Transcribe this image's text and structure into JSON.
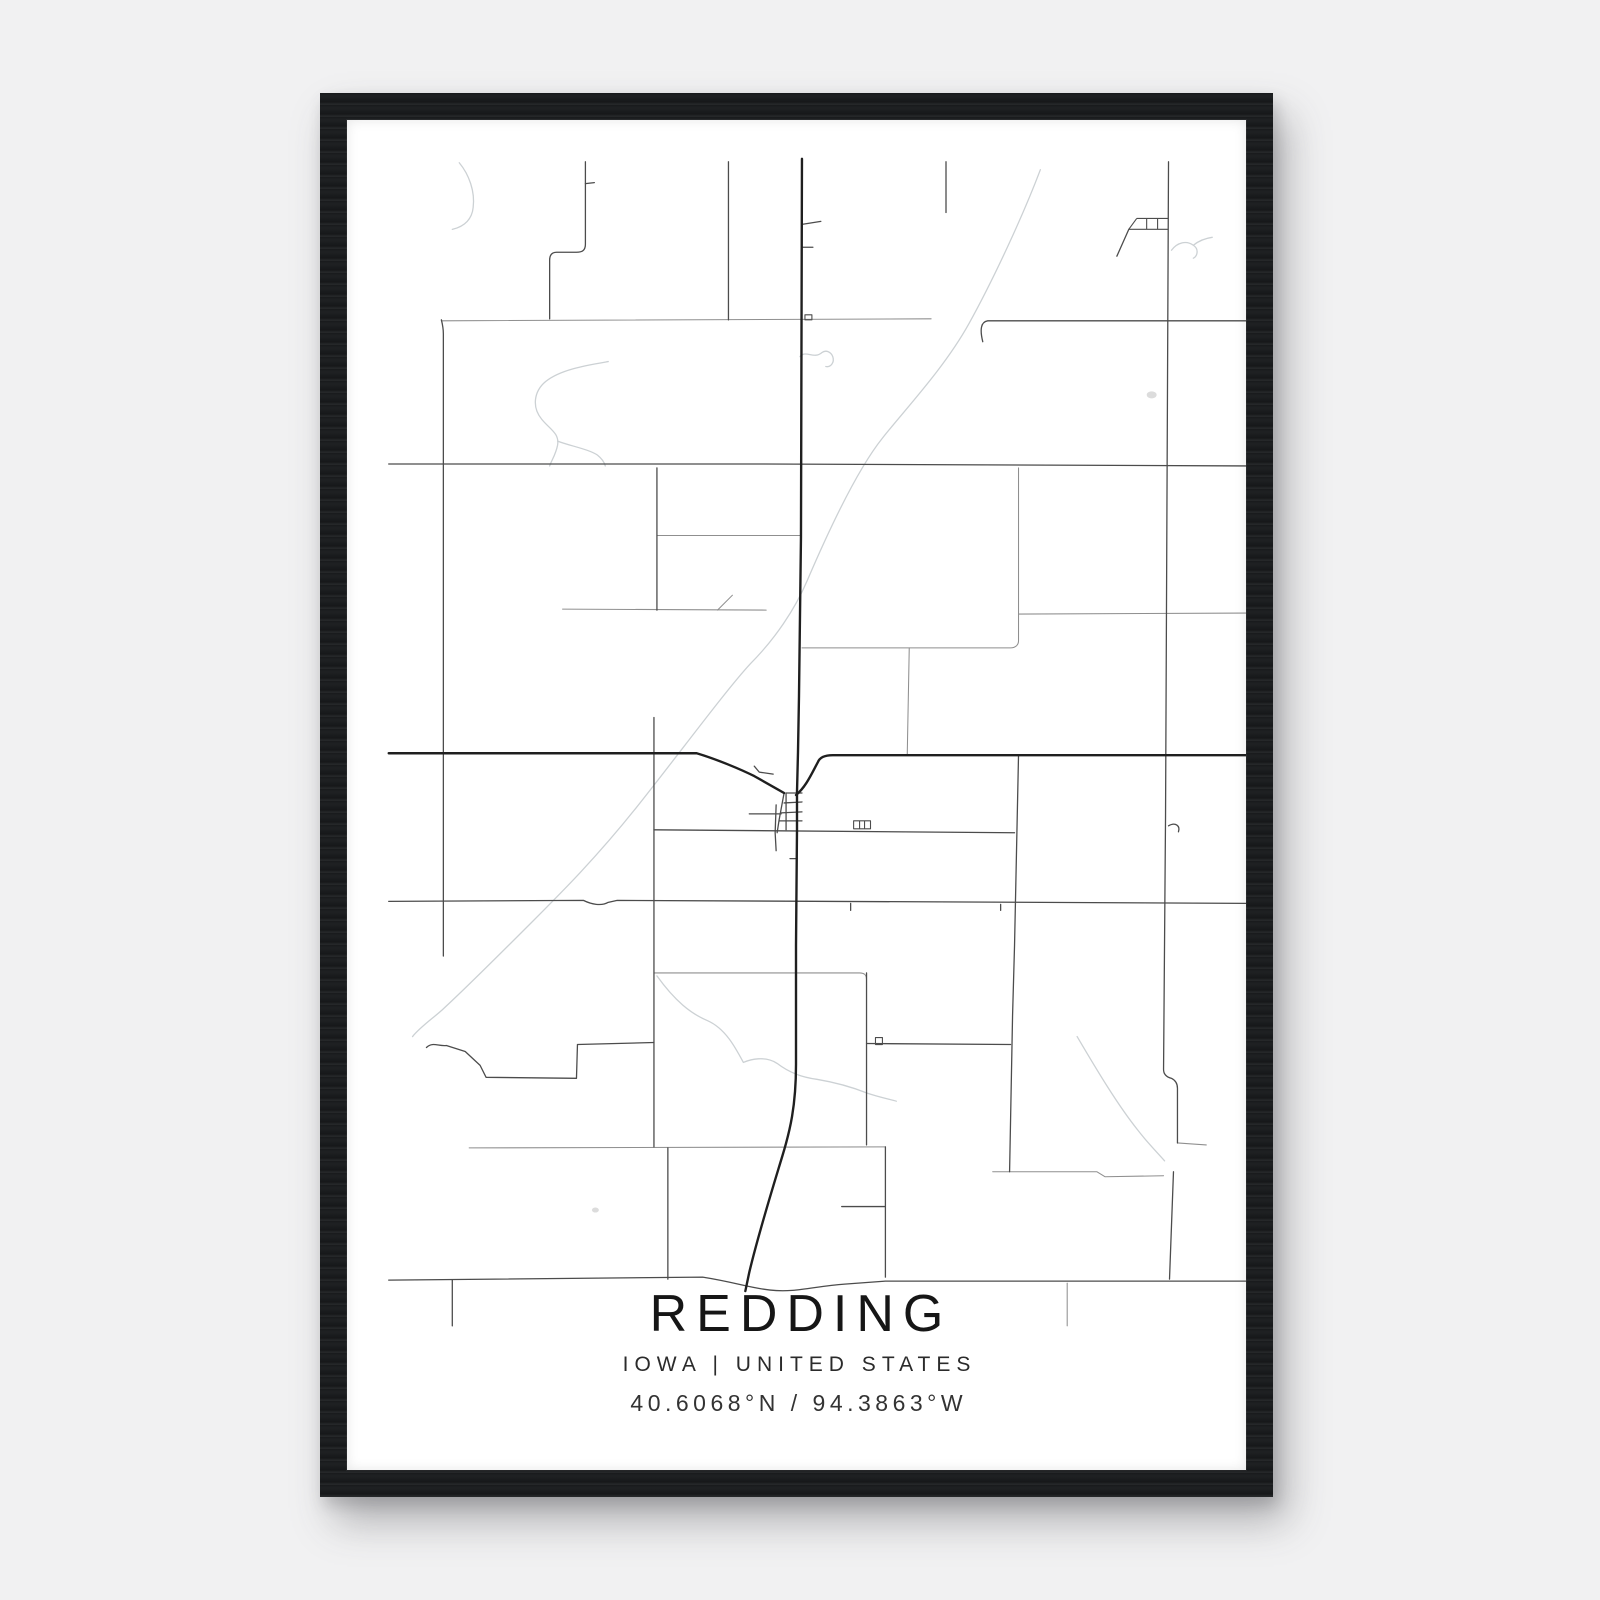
{
  "poster": {
    "title": "REDDING",
    "subtitle": "IOWA | UNITED STATES",
    "coordinates": "40.6068°N / 94.3863°W"
  },
  "colors": {
    "page_bg": "#f1f1f2",
    "frame": "#1b1d1f",
    "map_bg": "#ffffff",
    "road_major": "#1f1f1f",
    "road_minor": "#4c4c4c",
    "road_light": "#8f8f8f",
    "stream": "#ccd1d4",
    "text": "#1c1c1c"
  },
  "map": {
    "viewbox": "0 0 905 1358",
    "layers": [
      {
        "name": "streams",
        "class": "stream",
        "paths": [
          "M113,43 C123,55 129,72 127,88 C126,99 119,107 106,110",
          "M698,50 C681,95 651,160 626,205 C601,250 561,292 539,320 C511,355 481,422 463,464 C451,492 431,522 406,547 C381,574 331,642 291,692 C251,742 216,777 186,807 C161,832 121,872 96,895 C86,904 73,913 66,922",
          "M456,238 C462,231 470,241 478,234 C482,231 487,233 489,238 C491,244 487,249 482,248",
          "M263,243 C240,247 215,251 200,263 C188,273 186,289 196,301 C204,311 214,315 212,327 C210,337 206,342 204,348",
          "M212,323 C225,328 243,331 252,337 C257,341 259,344 260,348",
          "M312,861 C330,886 346,899 363,906 C381,914 391,933 399,948 C406,945 421,941 433,949 C446,959 459,963 473,965 C491,968 509,973 524,979 C536,983 546,985 553,987",
          "M735,922 C755,956 776,991 796,1016 C806,1029 816,1039 823,1047",
          "M830,131 C836,123 845,121 852,126 C858,130 856,137 852,139",
          "M852,126 C858,121 864,119 871,118"
        ]
      },
      {
        "name": "roads-light",
        "class": "road-light",
        "paths": [
          "M95,202 L588,200",
          "M312,418 L456,418",
          "M217,492 L422,493",
          "M373,493 L388,478",
          "M458,531 L668,531 C673,531 676,528 676,524 L676,350",
          "M676,497 L905,496",
          "M566,531 L564,638",
          "M123,1034 L542,1033",
          "M725,1170 L725,1213",
          "M650,1058 L755,1058 L763,1063 L822,1062",
          "M836,1029 L865,1031",
          "M309,858 L516,858 C521,858 523,860 523,865"
        ]
      },
      {
        "name": "roads-minor",
        "class": "road-minor",
        "paths": [
          "M640,223 C637,211 638,203 645,202 L905,202",
          "M42,346 L420,346 L905,348",
          "M42,786 L238,785 C246,789 256,791 263,787 L272,785 L905,788",
          "M240,42 L240,125 C240,131 237,133 231,133 L211,133 C206,133 204,136 204,141 L204,200",
          "M240,64 L249,63",
          "M95,201 C96,205 97,209 97,215 L97,841",
          "M384,42 L384,201",
          "M312,350 L312,493",
          "M603,42 L603,93",
          "M827,42 L824,700 L822,955 C822,961 826,963 830,964 C834,966 836,969 836,974 L836,1029",
          "M832,1058 L828,1166",
          "M309,601 L309,1033",
          "M676,639 L672,830 L670,901 L667,1058",
          "M309,714 L672,717",
          "M523,858 L523,1031",
          "M542,1033 L542,1164",
          "M498,1093 L542,1093",
          "M80,933 C86,927 92,932 100,931 L119,937 L134,951 L140,963 L231,964 L232,930 L309,928",
          "M523,929 L668,930",
          "M42,1167 L358,1164 C390,1169 406,1175 426,1177 C451,1180 471,1173 501,1171 L542,1168 L905,1168",
          "M106,1167 L106,1213",
          "M323,1034 L323,1166",
          "M787,110 L775,137",
          "M440,677 L435,704 L433,717",
          "M442,677 L458,677 M440,687 L458,686 M437,697 L458,696 M435,705 L458,705",
          "M405,698 L437,698",
          "M442,677 L442,714",
          "M432,689 L431,717 L432,735",
          "M446,743 L453,743",
          "M458,105 L477,102 M458,128 L469,128",
          "M507,788 L507,795 M658,789 L658,795",
          "M410,650 L415,656 L429,658",
          "M827,710 C834,706 839,710 837,716"
        ]
      },
      {
        "name": "roads-major",
        "class": "road-major",
        "paths": [
          "M458,39 L457,420 L455,580 L454,636 L453,676 L453,714 L452,830 L452,950 C452,992 446,1017 438,1043 C428,1076 414,1121 405,1159 L401,1178",
          "M42,637 L352,637 C372,643 396,653 410,660 L433,673 L440,677",
          "M452,679 C462,671 468,657 474,646 C476,641 481,639 489,639 L905,639"
        ]
      },
      {
        "name": "structures",
        "class": "structure",
        "paths": [
          "M795,99 L827,99 M787,110 L827,110 M795,99 L787,110 M805,99 L805,110 M816,99 L816,110",
          "M510,705 L527,705 L527,713 L510,713 Z M516,705 L516,713 M521,705 L521,713",
          "M532,923 L539,923 L539,930 L532,930 Z",
          "M461,196 L468,196 L468,201 L461,201 Z"
        ]
      },
      {
        "name": "ponds",
        "class": "pond",
        "paths": [
          "M810,273 a5,3.5 0 1 0 0.1,0 Z",
          "M250,1094 a3.5,2.5 0 1 0 0.1,0 Z"
        ]
      }
    ]
  }
}
